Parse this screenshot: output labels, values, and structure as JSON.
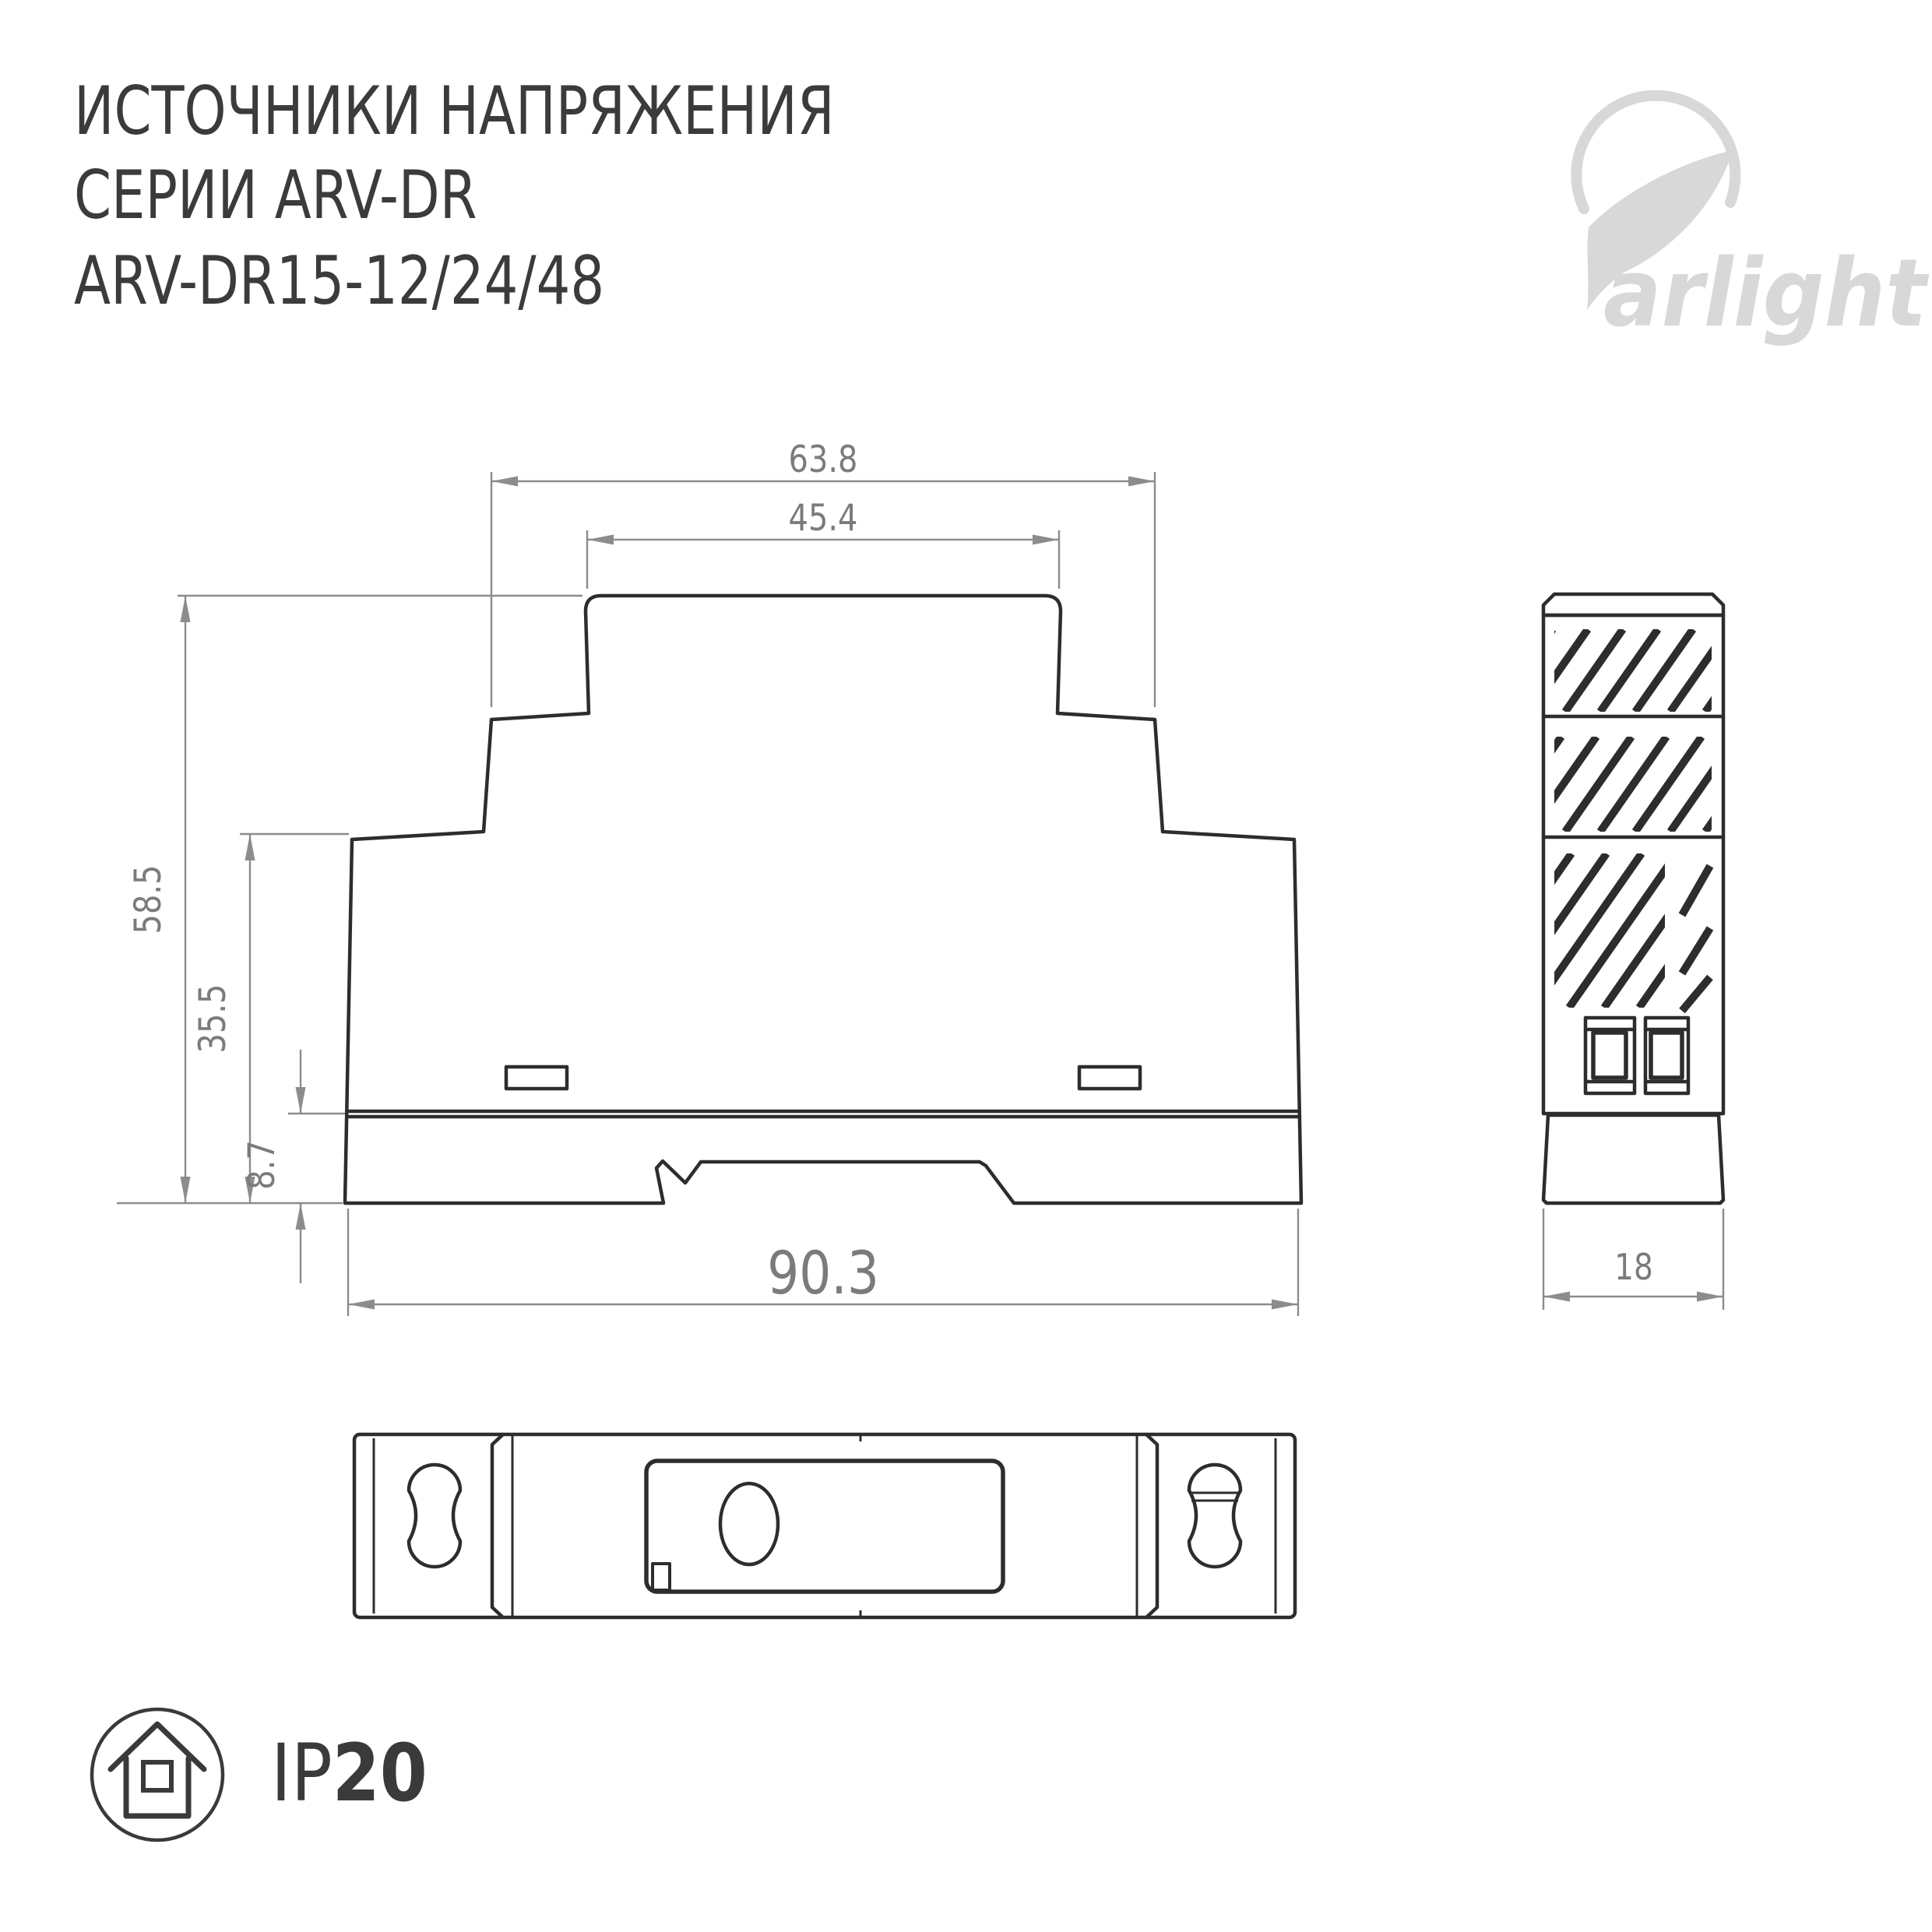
{
  "header": {
    "title_lines": [
      "ИСТОЧНИКИ НАПРЯЖЕНИЯ",
      "СЕРИИ ARV-DR",
      "ARV-DR15-12/24/48"
    ]
  },
  "logo": {
    "text": "arlight"
  },
  "dimensions": {
    "front": {
      "top_width": "63.8",
      "inner_top_width": "45.4",
      "total_height": "58.5",
      "body_height": "35.5",
      "rail_section_height": "8.7",
      "total_width": "90.3"
    },
    "side": {
      "depth": "18"
    }
  },
  "ip_rating": {
    "prefix": "IP",
    "value": "20"
  },
  "colors": {
    "object_line": "#2d2d2d",
    "dimension_line": "#8c8c8c",
    "dimension_text": "#7b7b7b",
    "title_text": "#3b3b3b",
    "logo_gray": "#d8d8d8"
  }
}
